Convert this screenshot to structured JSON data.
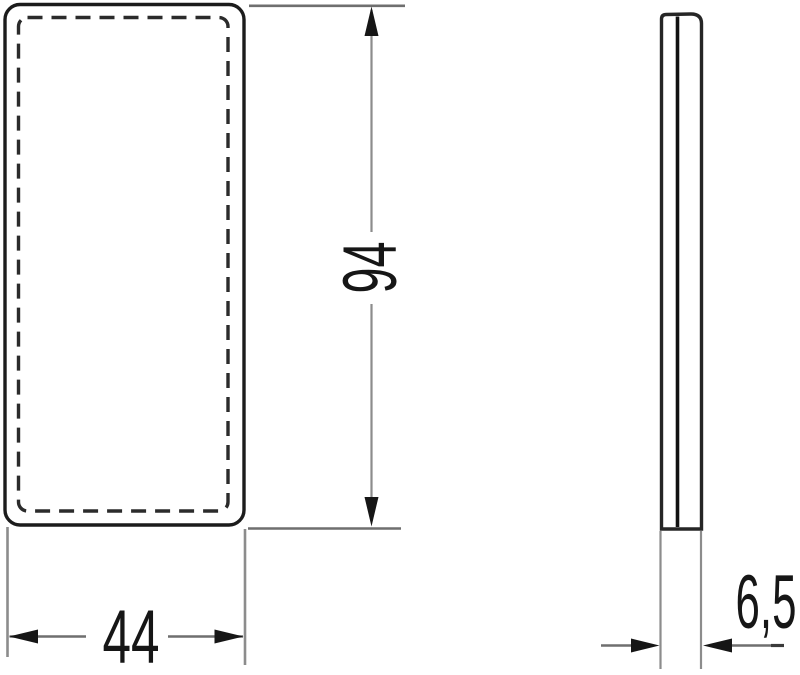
{
  "diagram": {
    "type": "technical-drawing-two-views",
    "colors": {
      "background": "#ffffff",
      "part_outline": "#1c1c1c",
      "dashed_outline": "#2b2b2b",
      "dimension_lines": "#8c8c8c",
      "extension_lines": "#6f6f6f",
      "arrows": "#161616",
      "text": "#161616"
    },
    "labels": {
      "height": "94",
      "width": "44",
      "depth": "6,5"
    }
  }
}
